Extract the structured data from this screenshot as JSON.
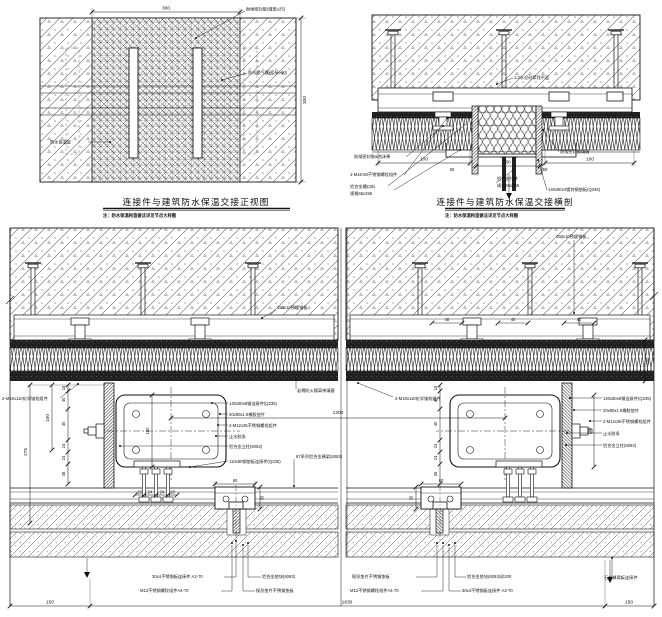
{
  "panel_a": {
    "title": "连接件与建筑防水保温交接正视图",
    "note": "注：防水保温构造做法详见节点大样图",
    "dim_width": "300",
    "dim_height": "300",
    "label_sealant": "耐候密封胶(缝宽≥25)",
    "label_membrane": "防水透气膜(搭接≥60)",
    "label_wall": "防水保温层"
  },
  "panel_b": {
    "title": "连接件与建筑防水保温交接横剖",
    "note": "注：防水保温构造做法详见节点大样图",
    "label_mortar": "1:3水泥砂浆找平层",
    "label_seal_left": "耐候密封胶&泡沫棒",
    "label_bolt": "1-M16-60不锈钢螺栓组件",
    "label_profile1": "铝合金槽口料",
    "label_profile2": "规格65x255",
    "label_bracket1": "铝合金托件",
    "label_bracket2": "规格65x255",
    "label_seal_right": "耐候密封胶填缝",
    "label_plate_right": "140x80x4镀锌钢垫板(Q345)",
    "dim_100_left": "100",
    "dim_100_right": "100",
    "dim_80": "80",
    "dim_50_left": "50",
    "dim_50_right": "50"
  },
  "section_left": {
    "label_embed": "150x10预埋钢板",
    "label_anchor": "2-M16x110化学锚栓组件",
    "label_firestop": "岩棉防火隔离带填塞",
    "label_beam": "87系列铝合金横梁(6063)",
    "mid_labels": [
      "140x80x6钢连接件(Q235)",
      "20x80x1.5橡胶垫片",
      "2-M12x35不锈钢螺栓组件",
      "止水胶条",
      "铝合金立柱(6063)",
      "110x80钢垫板连接件(Q235)"
    ],
    "bottom_labels": [
      "30x4不锈钢板连接件 A2-70",
      "M12不锈钢螺栓组件A4-70",
      "铝合金垫块(6063)",
      "楔形垫片不锈钢垫板"
    ],
    "dim_275": "275",
    "dim_100": "100",
    "dim_180": "180",
    "dim_60": "60",
    "dim_35": "35",
    "chain": [
      "15",
      "40",
      "40",
      "24",
      "24",
      "36"
    ],
    "bolt_chain": [
      "18",
      "24",
      "24",
      "18"
    ]
  },
  "section_right": {
    "label_embed": "150x10预埋钢板",
    "label_anchor": "2-M16x110化学锚栓组件",
    "side_labels": [
      "140x80x6钢连接件(Q235)",
      "20x80x1.5橡胶垫片",
      "2-M12x35不锈钢螺栓组件",
      "止水胶条",
      "铝合金立柱(6063)"
    ],
    "bottom_labels": [
      "楔形垫片不锈钢垫板",
      "M12不锈钢螺栓组件A4-70",
      "铝合金垫块(6063)@200",
      "30x4不锈钢板连接件 A2-70",
      "石材蜂窝板连接件"
    ],
    "dim_180": "180",
    "dim_100": "100",
    "dim_60": "60",
    "dim_35": "35",
    "embed_dims": [
      "40",
      "40",
      "40"
    ],
    "chain": [
      "15",
      "40",
      "40",
      "24",
      "24",
      "36"
    ]
  },
  "bottom_dims": {
    "seg_left": "150",
    "total": "1630",
    "seg_right": "150",
    "spacing": "1200"
  }
}
